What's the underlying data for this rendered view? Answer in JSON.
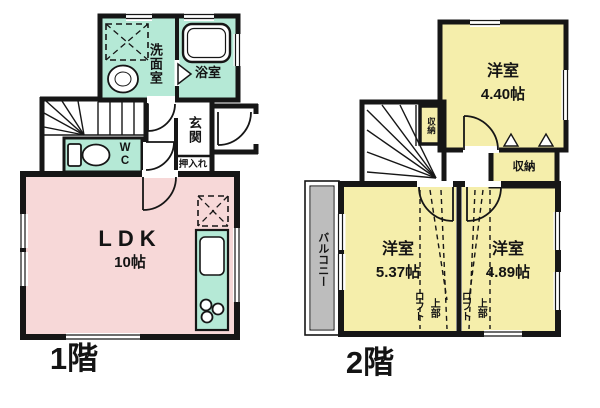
{
  "colors": {
    "wall": "#161616",
    "wet_area_fill": "#b5e9d6",
    "ldk_fill": "#f7d8d8",
    "bedroom_fill": "#f5eeab",
    "balcony_fill": "#bdbdbd",
    "background": "#ffffff"
  },
  "floor1": {
    "label": "1階",
    "washroom": "洗面室",
    "bathroom": "浴室",
    "entrance": "玄関",
    "wc": "WC",
    "closet": "押入れ",
    "ldk_name": "LDK",
    "ldk_size": "10帖"
  },
  "floor2": {
    "label": "2階",
    "bedroom1_name": "洋室",
    "bedroom1_size": "4.40帖",
    "stair_storage": "収納",
    "storage": "収納",
    "balcony": "バルコニー",
    "bedroom2_name": "洋室",
    "bedroom2_size": "5.37帖",
    "bedroom2_loft_line1": "ロフト",
    "bedroom2_loft_line2": "上部",
    "bedroom3_name": "洋室",
    "bedroom3_size": "4.89帖",
    "bedroom3_loft_line1": "ロフト",
    "bedroom3_loft_line2": "上部"
  }
}
